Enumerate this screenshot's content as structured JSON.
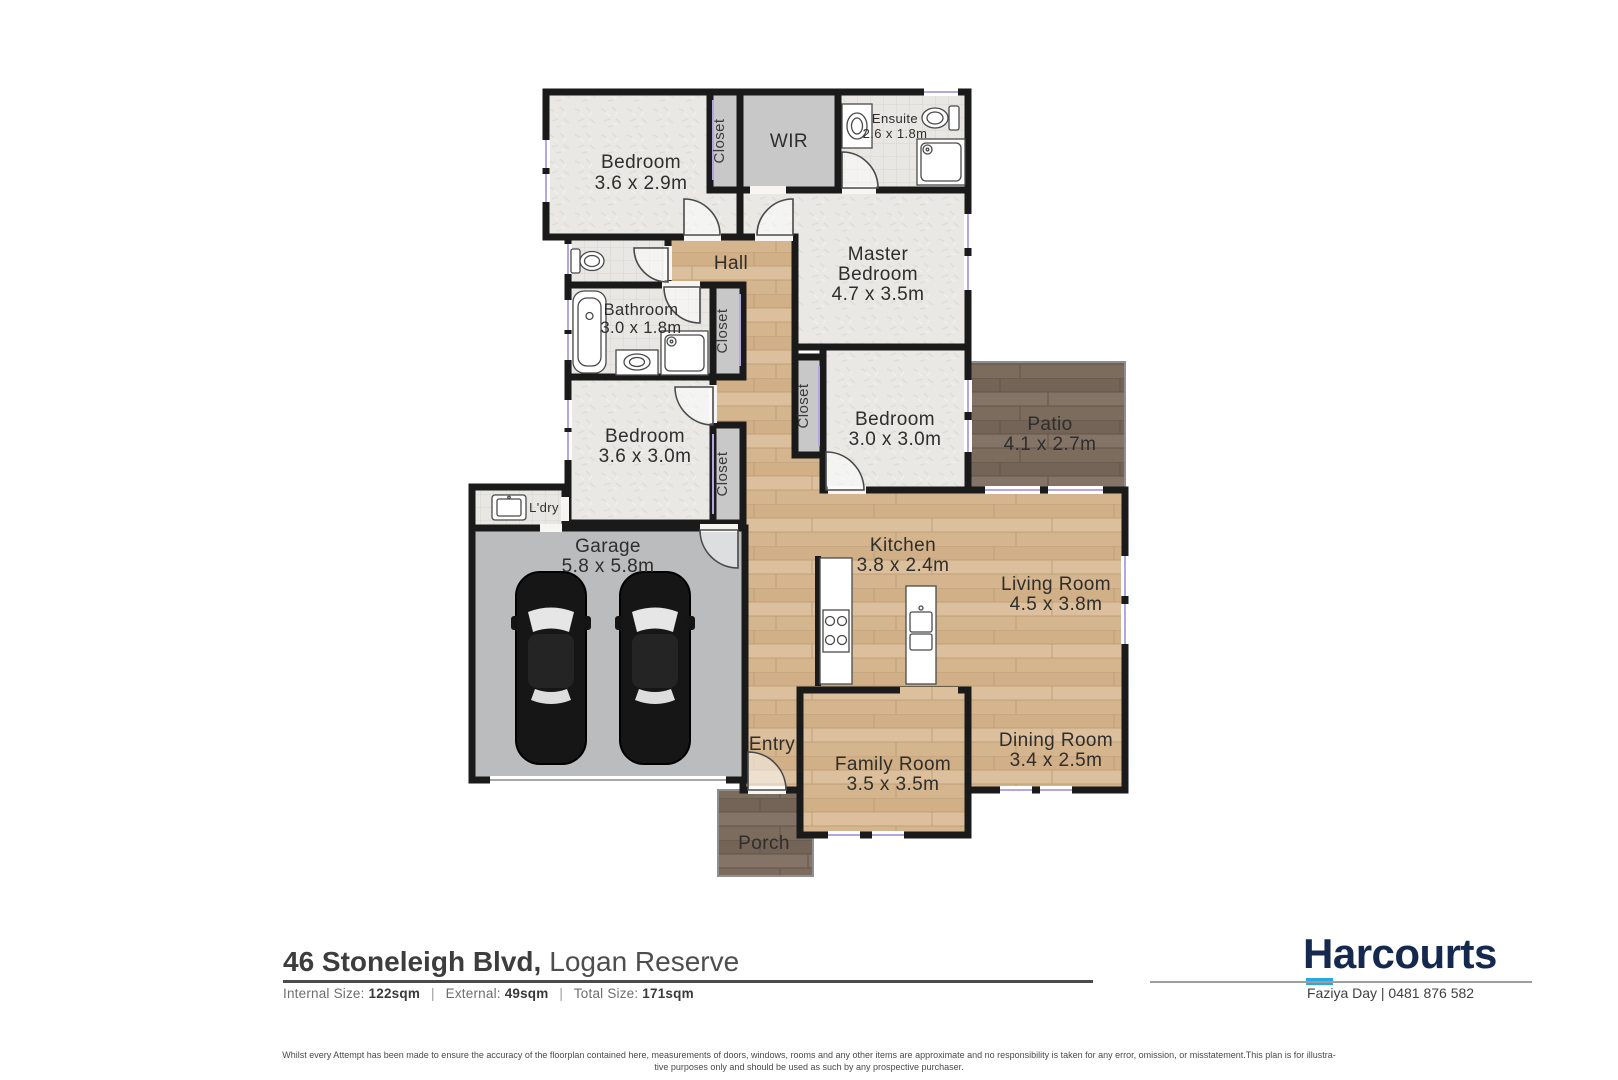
{
  "plan": {
    "rooms": {
      "bedroom1": {
        "name": "Bedroom",
        "dims": "3.6 x 2.9m"
      },
      "closet1": {
        "name": "Closet"
      },
      "wir": {
        "name": "WIR"
      },
      "ensuite": {
        "name": "Ensuite",
        "dims": "2.6 x 1.8m"
      },
      "master": {
        "name_line1": "Master",
        "name_line2": "Bedroom",
        "dims": "4.7 x 3.5m"
      },
      "hall": {
        "name": "Hall"
      },
      "bathroom": {
        "name": "Bathroom",
        "dims": "3.0 x 1.8m"
      },
      "closet2": {
        "name": "Closet"
      },
      "bedroom2": {
        "name": "Bedroom",
        "dims": "3.6 x 3.0m"
      },
      "closet3": {
        "name": "Closet"
      },
      "closet4": {
        "name": "Closet"
      },
      "bedroom3": {
        "name": "Bedroom",
        "dims": "3.0 x 3.0m"
      },
      "patio": {
        "name": "Patio",
        "dims": "4.1 x 2.7m"
      },
      "laundry": {
        "name": "L'dry"
      },
      "garage": {
        "name": "Garage",
        "dims": "5.8 x 5.8m"
      },
      "kitchen": {
        "name": "Kitchen",
        "dims": "3.8 x 2.4m"
      },
      "living": {
        "name": "Living Room",
        "dims": "4.5 x 3.8m"
      },
      "dining": {
        "name": "Dining Room",
        "dims": "3.4 x 2.5m"
      },
      "family": {
        "name": "Family Room",
        "dims": "3.5 x 3.5m"
      },
      "entry": {
        "name": "Entry"
      },
      "porch": {
        "name": "Porch"
      }
    }
  },
  "footer": {
    "address_primary": "46 Stoneleigh Blvd,",
    "address_secondary": "Logan Reserve",
    "internal_label": "Internal Size:",
    "internal_value": "122sqm",
    "separator": "|",
    "external_label": "External:",
    "external_value": "49sqm",
    "total_label": "Total Size:",
    "total_value": "171sqm",
    "brand_name": "Harcourts",
    "agent_line": "Faziya Day | 0481 876 582",
    "disclaimer_line1": "Whilst every Attempt has been made to ensure the accuracy of the floorplan contained here,  measurements of doors, windows, rooms and any other items are approximate and no responsibility is taken for any error, omission, or misstatement.This plan is for illustra-",
    "disclaimer_line2": "tive purposes only and should be used as such by any prospective purchaser."
  },
  "palette": {
    "brand_navy": "#15294e",
    "brand_accent": "#29a9e1",
    "wall": "#1a1a1a",
    "wood_light": "#d7b893",
    "wood_dark": "#7a6a5c",
    "closet_gray": "#c8c8c8",
    "garage_gray": "#babcbe",
    "window_accent": "#b3a6e2"
  }
}
